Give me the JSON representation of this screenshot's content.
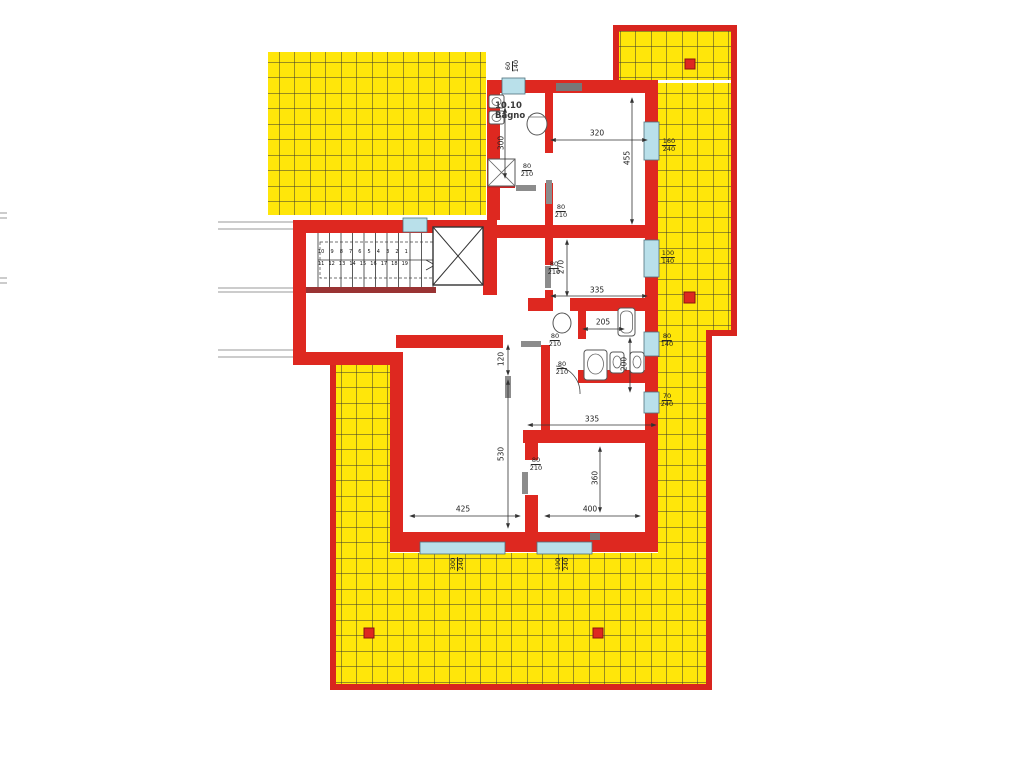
{
  "colors": {
    "wall_red": "#DE2820",
    "terrace_border_red": "#D8251E",
    "terrace_yellow": "#FFE60A",
    "grid_line": "#333333",
    "window_cyan": "#B9E0EA",
    "stair_flight_maroon": "#993333",
    "dim_text": "#1D1D1D",
    "door_leaf_gray": "#8C8C8C"
  },
  "room": {
    "id": "10.10",
    "name": "Bagno"
  },
  "door_label": {
    "w": "80",
    "h": "210"
  },
  "windows": [
    {
      "name": "top-window",
      "w": "60",
      "h": "140"
    },
    {
      "name": "right-window-1",
      "w": "160",
      "h": "240"
    },
    {
      "name": "right-window-2",
      "w": "100",
      "h": "140"
    },
    {
      "name": "right-window-3",
      "w": "80",
      "h": "140"
    },
    {
      "name": "right-window-4",
      "w": "70",
      "h": "240"
    },
    {
      "name": "bottom-window-1",
      "w": "300",
      "h": "240"
    },
    {
      "name": "bottom-window-2",
      "w": "190",
      "h": "240"
    }
  ],
  "dims": {
    "bagno_height": "300",
    "bed1_width": "320",
    "bed1_height": "455",
    "bed2_height": "270",
    "bed2_width": "335",
    "bath_width": "205",
    "bath_height": "200",
    "hall_opening": "120",
    "living_height": "530",
    "living_width": "425",
    "bed3_width": "400",
    "bed3_height": "360",
    "bed3_top_width": "335"
  },
  "stairs": {
    "upper_row": "10 9 8 7 6 5 4 3 2 1",
    "lower_row": "11 12 13 14 15 16 17 18 19"
  }
}
